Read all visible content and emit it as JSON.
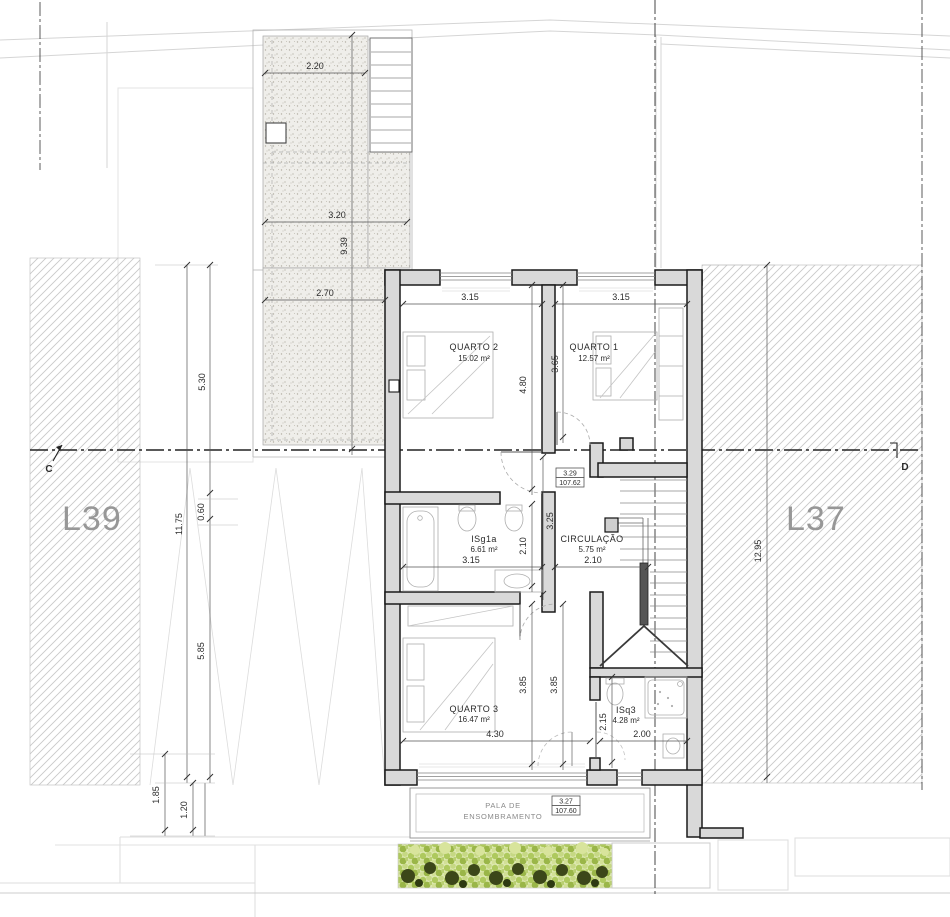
{
  "drawing": {
    "type": "floor-plan",
    "lots": {
      "left_label": "L39",
      "right_label": "L37"
    },
    "section_markers": {
      "left": "C",
      "right": "D"
    },
    "levels": {
      "floor": {
        "relative": "3.29",
        "absolute": "107.62"
      },
      "canopy": {
        "relative": "3.27",
        "absolute": "107.60"
      }
    },
    "rooms": {
      "quarto2": {
        "name": "QUARTO 2",
        "area": "15.02 m²"
      },
      "quarto1": {
        "name": "QUARTO 1",
        "area": "12.57 m²"
      },
      "isg1a": {
        "name": "ISg1a",
        "area": "6.61 m²"
      },
      "circulacao": {
        "name": "CIRCULAÇÃO",
        "area": "5.75 m²"
      },
      "quarto3": {
        "name": "QUARTO 3",
        "area": "16.47 m²"
      },
      "isq3": {
        "name": "ISq3",
        "area": "4.28 m²"
      }
    },
    "annotations": {
      "pala_line1": "PALA DE",
      "pala_line2": "ENSOMBRAMENTO"
    },
    "dimensions": {
      "patio_top": "2.20",
      "patio_mid": "3.20",
      "patio_low": "2.70",
      "patio_len": "9.39",
      "left_a": "5.30",
      "left_b": "0.60",
      "left_c": "5.85",
      "left_total": "11.75",
      "left_d": "1.85",
      "left_e": "1.20",
      "q2_w": "3.15",
      "q1_w": "3.15",
      "q2_d": "4.80",
      "q1_d": "3.65",
      "bath_w": "3.15",
      "bath_d": "2.10",
      "circ_w": "2.10",
      "circ_d": "3.25",
      "q3_w": "4.30",
      "q3_d": "3.85",
      "q3_d2": "3.85",
      "isq3_w": "2.00",
      "isq3_d": "2.15",
      "lot_right": "12.95"
    },
    "colors": {
      "wall_fill": "#d9d9d9",
      "wall_line": "#1a1a1a",
      "hatch": "#c6c6c6",
      "hedge_light": "#b5cc6a",
      "hedge_dark": "#3c4719",
      "label_gray": "#979797"
    }
  }
}
